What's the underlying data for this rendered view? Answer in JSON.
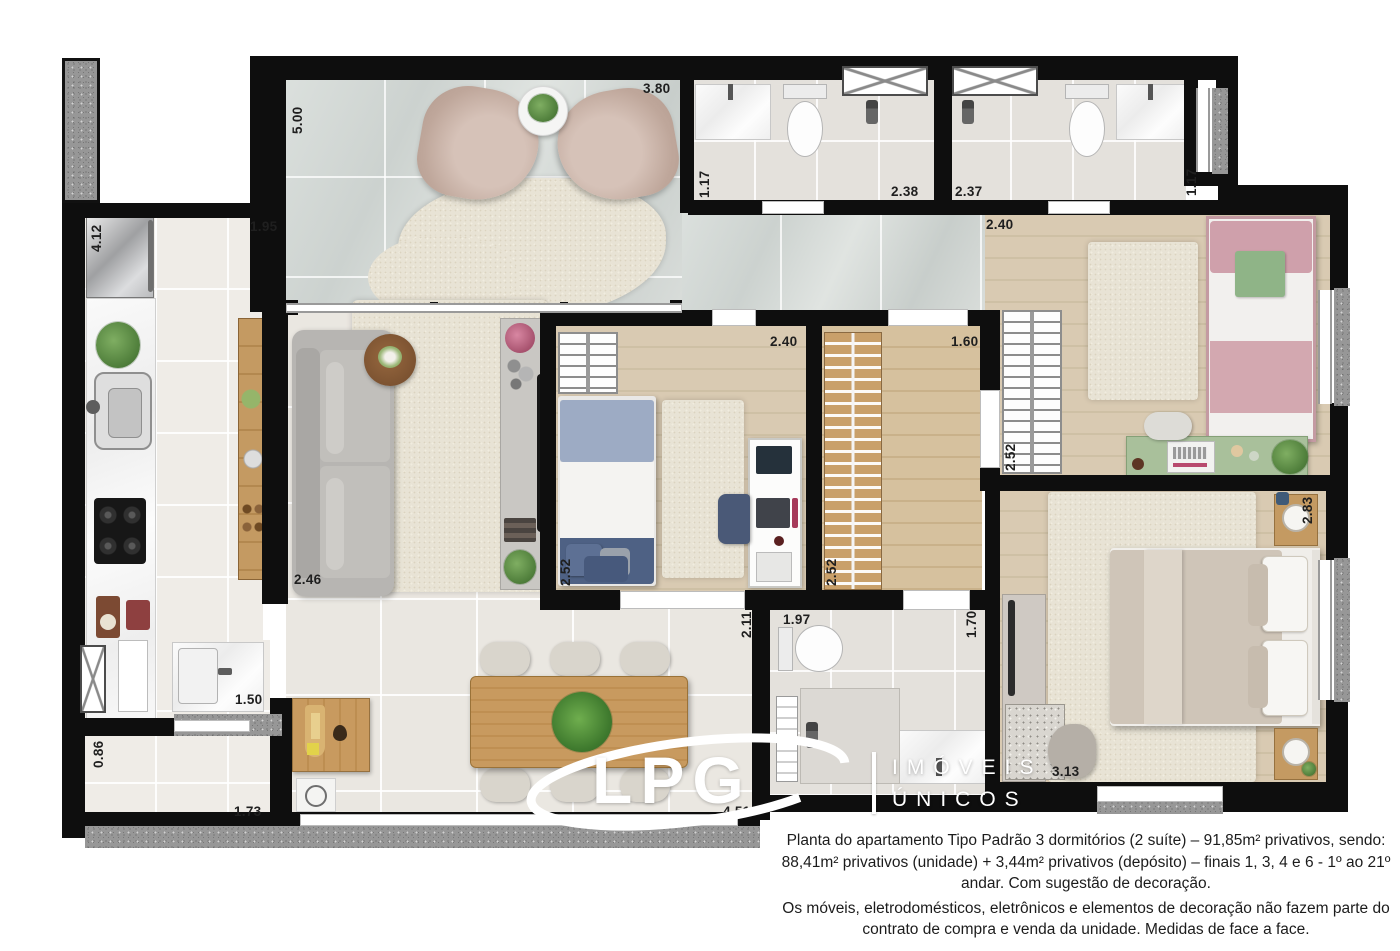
{
  "logo": {
    "brand": "LPG",
    "tagline1": "IMÓVEIS",
    "tagline2": "ÚNICOS"
  },
  "caption": {
    "paragraph1": "Planta do apartamento Tipo Padrão 3 dormitórios (2 suíte) – 91,85m² privativos, sendo: 88,41m² privativos (unidade) + 3,44m² privativos (depósito) – finais 1, 3, 4 e 6 - 1º ao 21º andar. Com sugestão de decoração.",
    "paragraph2": "Os móveis, eletrodomésticos, eletrônicos e elementos de decoração não fazem parte do contrato de compra e venda da unidade. Medidas de face a face."
  },
  "measurements": [
    "5.00",
    "3.80",
    "1.17",
    "2.38",
    "2.37",
    "1.17",
    "2.40",
    "4.12",
    "1.95",
    "2.40",
    "1.60",
    "2.52",
    "2.52",
    "2.52",
    "2.46",
    "2.83",
    "3.13",
    "1.97",
    "1.70",
    "2.11",
    "1.50",
    "0.86",
    "1.73",
    "4.51"
  ],
  "colors": {
    "wall": "#0e0e0e",
    "granite": "#979797",
    "wood_floor": "#d9cab2",
    "marble_floor": "#ccd2cf",
    "pink_bed": "#cfa3ab",
    "blue_bed": "#4e6184",
    "green_desk": "#a9c09b",
    "master_bed": "#cfc5b8"
  }
}
